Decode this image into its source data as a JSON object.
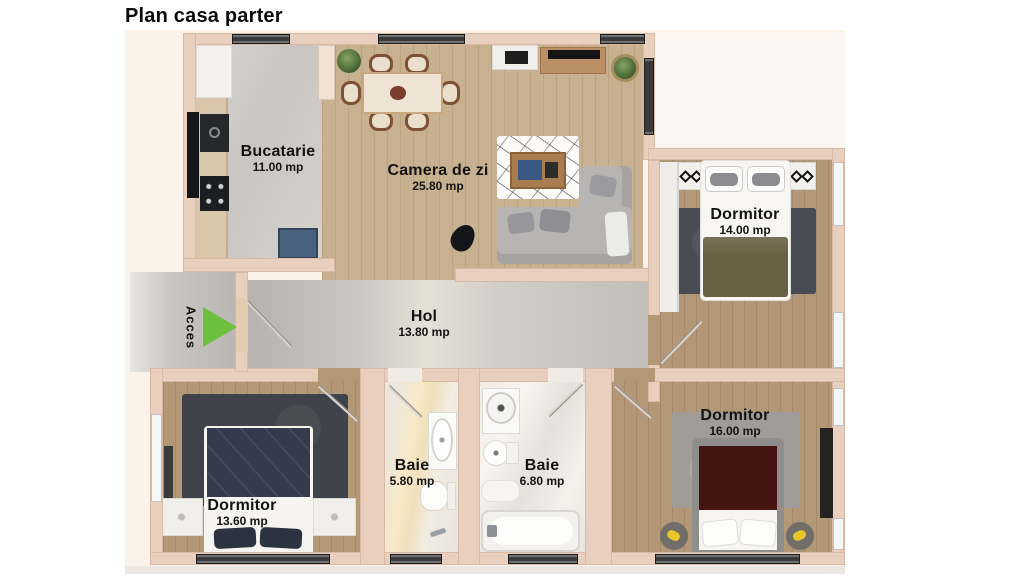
{
  "title": "Plan casa parter",
  "access_label": "Acces",
  "rooms": {
    "bucatarie": {
      "name": "Bucatarie",
      "area": "11.00 mp"
    },
    "camera_de_zi": {
      "name": "Camera de zi",
      "area": "25.80 mp"
    },
    "dormitor_right": {
      "name": "Dormitor",
      "area": "14.00 mp"
    },
    "hol": {
      "name": "Hol",
      "area": "13.80 mp"
    },
    "dormitor_left": {
      "name": "Dormitor",
      "area": "13.60 mp"
    },
    "baie_small": {
      "name": "Baie",
      "area": "5.80 mp"
    },
    "baie_large": {
      "name": "Baie",
      "area": "6.80 mp"
    },
    "dormitor_bottom": {
      "name": "Dormitor",
      "area": "16.00 mp"
    }
  },
  "colors": {
    "plan_background": "#fbf2e9",
    "wall": "#e9cfbe",
    "accent_green": "#6dbf40",
    "label_text": "#131313"
  }
}
